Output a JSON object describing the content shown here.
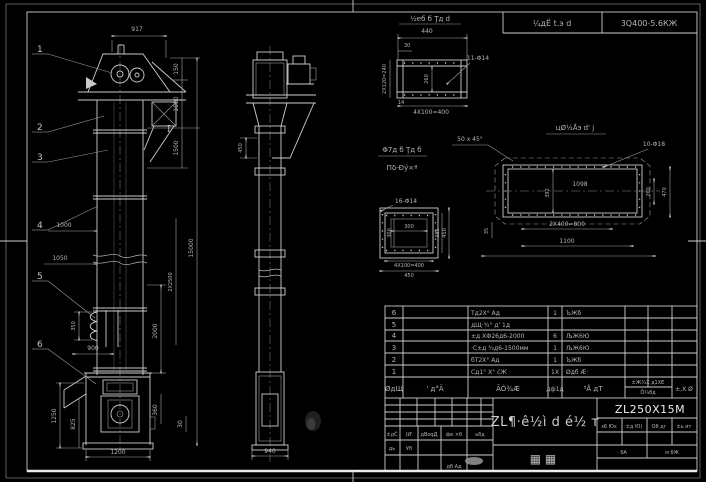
{
  "header": {
    "process_note": "¼дЁ t.э d",
    "spec": "3Q400-5.6КЖ"
  },
  "balloons": {
    "b1": "1",
    "b2": "2",
    "b3": "3",
    "b4": "4",
    "b5": "5",
    "b6": "6"
  },
  "section_mark": "I",
  "front": {
    "w917": "917",
    "h150": "150",
    "h1000": "1000",
    "h1500": "1500",
    "h15000": "15000",
    "c2x2500": "2X2500",
    "h2000": "2000",
    "h360": "360",
    "h30": "30",
    "d1000": "1000",
    "d1050": "1050",
    "v350": "350",
    "w900": "900",
    "v1250": "1250",
    "v825": "825",
    "w1200": "1200"
  },
  "side": {
    "v450": "450",
    "w940": "940"
  },
  "flange_detail": {
    "title": "½еб б Ţд d",
    "w440": "440",
    "w30": "30",
    "holes": "11-Φ14",
    "v240": "2X120=240",
    "v260": "260",
    "v14": "14",
    "pitch": "4X100=400"
  },
  "inlet_detail": {
    "title1": "Φ7д б Ţд б",
    "title2": "Пδ-Đý×ª",
    "holes": "16-Φ14",
    "w300": "300",
    "v300": "300",
    "v385": "385",
    "v450": "450",
    "pitch": "4X100=400",
    "w450": "450"
  },
  "plan_detail": {
    "title": "цØ½Åэ d' ј",
    "chamfer": "50 x 45°",
    "holes": "10-Φ18",
    "w1098": "1098",
    "v392": "392",
    "v260": "260",
    "v470": "470",
    "v35": "35",
    "pitch": "2X400=800",
    "w1100": "1100"
  },
  "parts": {
    "headers": {
      "no": "ØдЩ",
      "code": "' д°Ä",
      "name": "ÃÓ¾Æ",
      "qty": "дф1д",
      "material": "³Å дТ",
      "weight_top": "±Ж¾Х д1ХЕ",
      "weight_bottom": "Ô¾бд",
      "note": "±,Х Ø"
    },
    "rows": [
      {
        "no": "6",
        "code": "",
        "name": "Тд2Х° Ад",
        "qty": "1",
        "material": "ЪЖб",
        "w1": "",
        "w2": "",
        "note": ""
      },
      {
        "no": "5",
        "code": "",
        "name": "дЩ·¾° д' 1д",
        "qty": "",
        "material": "",
        "w1": "",
        "w2": "",
        "note": ""
      },
      {
        "no": "4",
        "code": "",
        "name": "±д ХФ26д6-2000",
        "qty": "6",
        "material": "ЉЖ6Ю",
        "w1": "",
        "w2": "",
        "note": ""
      },
      {
        "no": "3",
        "code": "",
        "name": "·С±д ¾д6-1500мм",
        "qty": "1",
        "material": "ЉЖ6Ю",
        "w1": "",
        "w2": "",
        "note": ""
      },
      {
        "no": "2",
        "code": "",
        "name": "бТ2Х° Ад",
        "qty": "1",
        "material": "ЪЖб",
        "w1": "",
        "w2": "",
        "note": ""
      },
      {
        "no": "1",
        "code": "",
        "name": "Сд1° Х° ćЖ",
        "qty": "1X",
        "material": "Øдб Æ·",
        "w1": "",
        "w2": "",
        "note": ""
      }
    ]
  },
  "titleblock": {
    "title": "ZL¶·ê½ì d é½ т",
    "model": "ZL250X15M",
    "stamp": "▦ ▦",
    "rev_row": [
      "±дČ",
      "(И'",
      "дВоqД",
      "фе ×б",
      "ьбд"
    ],
    "sign_row": [
      "дь",
      "Уб"
    ],
    "approve": "дб Ад",
    "right_headers": [
      "з6 Юх",
      "±д Ю)",
      "Об дг",
      "±ь ит"
    ],
    "sheet_left": "· бА",
    "sheet_right": "м бЖ"
  }
}
